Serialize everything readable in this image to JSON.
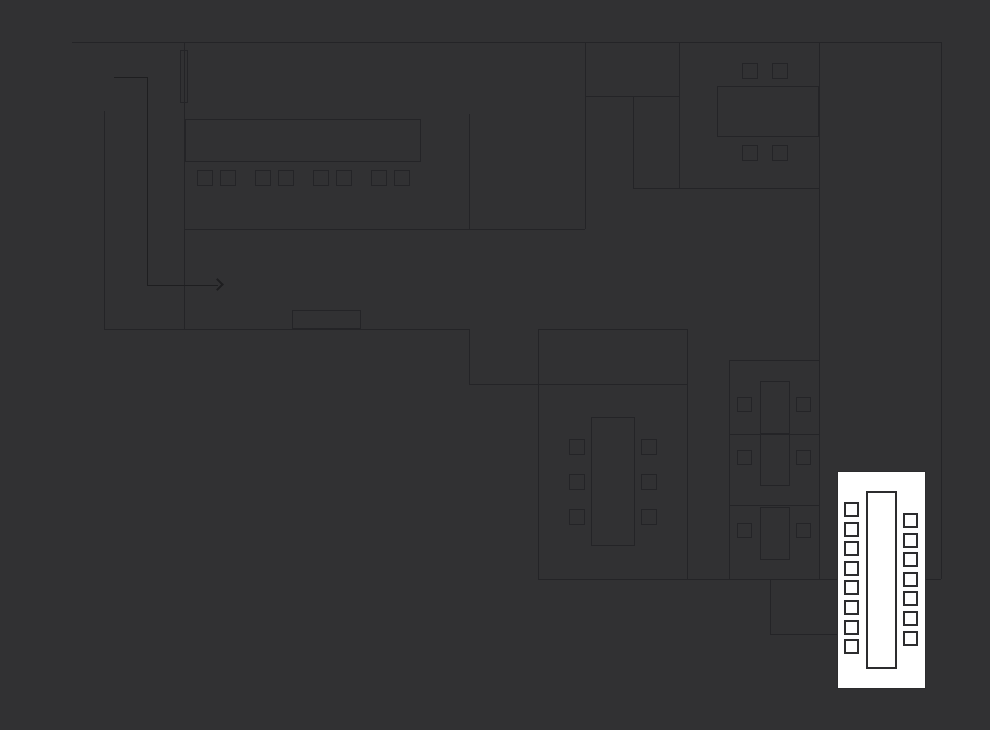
{
  "canvas": {
    "width": 990,
    "height": 730,
    "background": "#313133",
    "wall_color": "#242427",
    "arrow_color": "#1e1e20",
    "highlight_fill": "#ffffff",
    "highlight_border": "#2c2c2e"
  },
  "floorplan": {
    "walls": [
      {
        "name": "outer-wall-top",
        "x1": 72,
        "y1": 42,
        "x2": 941,
        "y2": 42
      },
      {
        "name": "outer-wall-right",
        "x1": 941,
        "y1": 42,
        "x2": 941,
        "y2": 579
      },
      {
        "name": "wall-main-left",
        "x1": 184,
        "y1": 42,
        "x2": 184,
        "y2": 329
      },
      {
        "name": "wall-lobby-left",
        "x1": 104,
        "y1": 111,
        "x2": 104,
        "y2": 329
      },
      {
        "name": "wall-lobby-bottom",
        "x1": 104,
        "y1": 329,
        "x2": 469,
        "y2": 329
      },
      {
        "name": "wall-openspace-bottom",
        "x1": 185,
        "y1": 229,
        "x2": 585,
        "y2": 229
      },
      {
        "name": "wall-openspace-partition",
        "x1": 469,
        "y1": 114,
        "x2": 469,
        "y2": 229
      },
      {
        "name": "wall-openspace-right",
        "x1": 585,
        "y1": 42,
        "x2": 585,
        "y2": 229
      },
      {
        "name": "wall-small-room-bottom",
        "x1": 585,
        "y1": 96,
        "x2": 679,
        "y2": 96
      },
      {
        "name": "wall-closet-left",
        "x1": 633,
        "y1": 96,
        "x2": 633,
        "y2": 188
      },
      {
        "name": "wall-closet-bottom",
        "x1": 633,
        "y1": 188,
        "x2": 819,
        "y2": 188
      },
      {
        "name": "wall-meeting-room-left",
        "x1": 679,
        "y1": 42,
        "x2": 679,
        "y2": 188
      },
      {
        "name": "wall-right-wing",
        "x1": 819,
        "y1": 42,
        "x2": 819,
        "y2": 579
      },
      {
        "name": "wall-corridor-step-left",
        "x1": 469,
        "y1": 329,
        "x2": 469,
        "y2": 384
      },
      {
        "name": "wall-corridor-step-bottom",
        "x1": 469,
        "y1": 384,
        "x2": 687,
        "y2": 384
      },
      {
        "name": "wall-conference-top",
        "x1": 538,
        "y1": 329,
        "x2": 687,
        "y2": 329
      },
      {
        "name": "wall-conference-left",
        "x1": 538,
        "y1": 329,
        "x2": 538,
        "y2": 579
      },
      {
        "name": "wall-conference-right",
        "x1": 687,
        "y1": 329,
        "x2": 687,
        "y2": 579
      },
      {
        "name": "wall-bottom",
        "x1": 538,
        "y1": 579,
        "x2": 941,
        "y2": 579
      },
      {
        "name": "wall-desk-room-top",
        "x1": 729,
        "y1": 360,
        "x2": 819,
        "y2": 360
      },
      {
        "name": "wall-desk-room-left",
        "x1": 729,
        "y1": 360,
        "x2": 729,
        "y2": 579
      },
      {
        "name": "wall-desk-divider-1",
        "x1": 729,
        "y1": 434,
        "x2": 819,
        "y2": 434
      },
      {
        "name": "wall-desk-divider-2",
        "x1": 729,
        "y1": 505,
        "x2": 819,
        "y2": 505
      },
      {
        "name": "wall-notch-left",
        "x1": 770,
        "y1": 579,
        "x2": 770,
        "y2": 634
      },
      {
        "name": "wall-notch-bottom",
        "x1": 770,
        "y1": 634,
        "x2": 837,
        "y2": 634
      }
    ],
    "door_leaf": {
      "name": "door-leaf",
      "x": 180,
      "y": 50,
      "w": 8,
      "h": 53
    },
    "entry_arrow": {
      "segments": [
        {
          "x1": 114,
          "y1": 77,
          "x2": 147,
          "y2": 77
        },
        {
          "x1": 147,
          "y1": 77,
          "x2": 147,
          "y2": 285
        },
        {
          "x1": 147,
          "y1": 285,
          "x2": 218,
          "y2": 285
        }
      ],
      "head": {
        "x": 222,
        "y": 285
      }
    },
    "tables": [
      {
        "name": "table-openspace",
        "x": 185,
        "y": 119,
        "w": 236,
        "h": 43
      },
      {
        "name": "table-meeting-north",
        "x": 717,
        "y": 86,
        "w": 102,
        "h": 51
      },
      {
        "name": "table-conference",
        "x": 591,
        "y": 417,
        "w": 44,
        "h": 129
      },
      {
        "name": "cabinet-lobby",
        "x": 292,
        "y": 310,
        "w": 69,
        "h": 19
      },
      {
        "name": "desk-1",
        "x": 760,
        "y": 381,
        "w": 30,
        "h": 53
      },
      {
        "name": "desk-2",
        "x": 760,
        "y": 434,
        "w": 30,
        "h": 52
      },
      {
        "name": "desk-3",
        "x": 760,
        "y": 507,
        "w": 30,
        "h": 53
      }
    ],
    "chair_groups": [
      {
        "name": "openspace-chair",
        "size": 16,
        "positions": [
          [
            197,
            170
          ],
          [
            220,
            170
          ],
          [
            255,
            170
          ],
          [
            278,
            170
          ],
          [
            313,
            170
          ],
          [
            336,
            170
          ],
          [
            371,
            170
          ],
          [
            394,
            170
          ]
        ]
      },
      {
        "name": "meeting-north-chair",
        "size": 16,
        "positions": [
          [
            742,
            63
          ],
          [
            772,
            63
          ],
          [
            742,
            145
          ],
          [
            772,
            145
          ]
        ]
      },
      {
        "name": "conference-chair",
        "size": 16,
        "positions": [
          [
            569,
            439
          ],
          [
            569,
            474
          ],
          [
            569,
            509
          ],
          [
            641,
            439
          ],
          [
            641,
            474
          ],
          [
            641,
            509
          ]
        ]
      },
      {
        "name": "desk-chair",
        "size": 15,
        "positions": [
          [
            737,
            397
          ],
          [
            796,
            397
          ],
          [
            737,
            450
          ],
          [
            796,
            450
          ],
          [
            737,
            523
          ],
          [
            796,
            523
          ]
        ]
      }
    ],
    "highlight_room": {
      "name": "selected-meeting-room",
      "rect": {
        "x": 837,
        "y": 471,
        "w": 89,
        "h": 218
      },
      "table": {
        "name": "selected-room-table",
        "x": 866,
        "y": 491,
        "w": 31,
        "h": 178
      },
      "chairs_left": {
        "name": "selected-room-chair-left",
        "x": 844,
        "size": 15,
        "ys": [
          502,
          522,
          541,
          561,
          580,
          600,
          620,
          639
        ]
      },
      "chairs_right": {
        "name": "selected-room-chair-right",
        "x": 903,
        "size": 15,
        "ys": [
          513,
          533,
          552,
          572,
          591,
          611,
          631
        ]
      }
    }
  }
}
